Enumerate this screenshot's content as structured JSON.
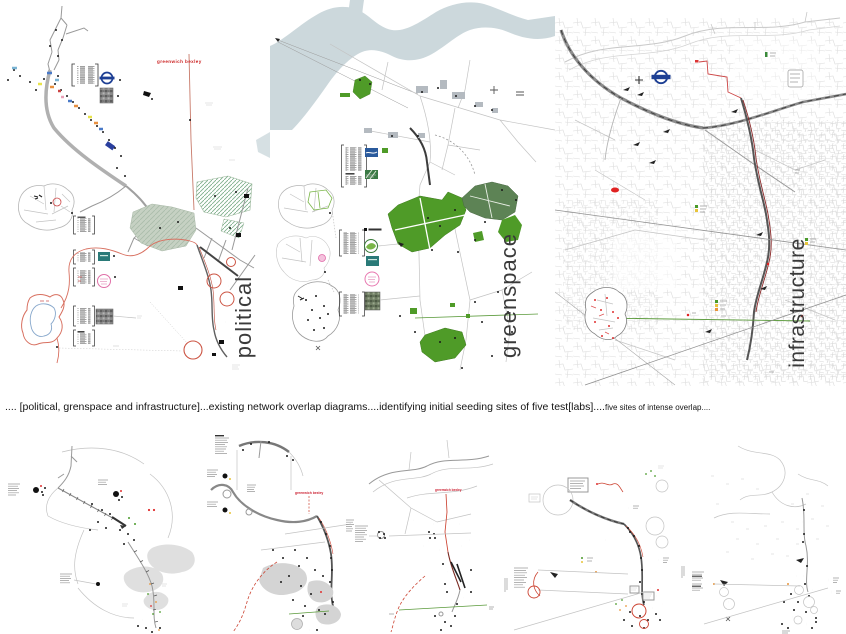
{
  "canvas": {
    "width": 846,
    "height": 634,
    "background": "#ffffff"
  },
  "top_maps": {
    "political": {
      "title": "political",
      "red_line_label": "greenwich bexley"
    },
    "greenspace": {
      "title": "greenspace"
    },
    "infrastructure": {
      "title": "infrastructure"
    }
  },
  "caption": {
    "main": ".... [political, grenspace and infrastructure]...existing network overlap diagrams....identifying initial seeding sites of five test[labs]....",
    "small": "five sites of intense overlap...."
  },
  "bottom_maps": {
    "map2": {
      "red_line_label": "greenwich bexley"
    },
    "map3": {
      "red_line_label": "greenwich bexley"
    }
  },
  "colors": {
    "park_green": "#4f9b28",
    "dark_park_green": "#5d8355",
    "river": "#ccd8dc",
    "route_red": "#cc3333",
    "corridor_red": "#8b2a2a",
    "roundel_blue": "#1d3f94",
    "hatch_green": "#7fae8c",
    "title_gray": "#3a3a3a"
  }
}
